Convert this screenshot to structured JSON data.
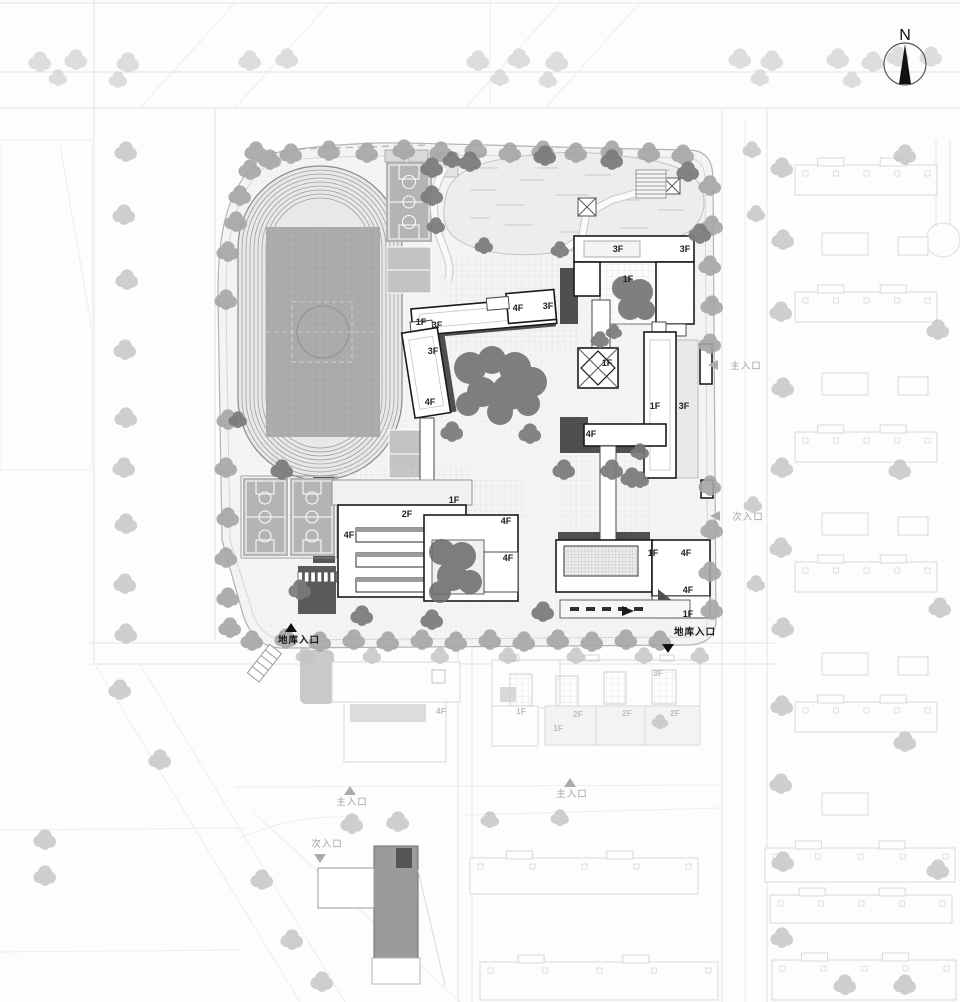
{
  "plan": {
    "north_label": "N",
    "floor_labels": [
      {
        "text": "3F",
        "x": 618,
        "y": 252,
        "tone": "dark"
      },
      {
        "text": "3F",
        "x": 685,
        "y": 252,
        "tone": "dark"
      },
      {
        "text": "1F",
        "x": 628,
        "y": 282,
        "tone": "dark"
      },
      {
        "text": "4F",
        "x": 518,
        "y": 311,
        "tone": "dark"
      },
      {
        "text": "3F",
        "x": 548,
        "y": 309,
        "tone": "dark"
      },
      {
        "text": "1F",
        "x": 421,
        "y": 325,
        "tone": "dark"
      },
      {
        "text": "3F",
        "x": 437,
        "y": 328,
        "tone": "dark"
      },
      {
        "text": "3F",
        "x": 433,
        "y": 354,
        "tone": "dark"
      },
      {
        "text": "4F",
        "x": 430,
        "y": 405,
        "tone": "dark"
      },
      {
        "text": "1F",
        "x": 607,
        "y": 366,
        "tone": "dark"
      },
      {
        "text": "1F",
        "x": 655,
        "y": 409,
        "tone": "dark"
      },
      {
        "text": "3F",
        "x": 684,
        "y": 409,
        "tone": "dark"
      },
      {
        "text": "4F",
        "x": 591,
        "y": 437,
        "tone": "dark"
      },
      {
        "text": "1F",
        "x": 454,
        "y": 503,
        "tone": "dark"
      },
      {
        "text": "2F",
        "x": 407,
        "y": 517,
        "tone": "dark"
      },
      {
        "text": "4F",
        "x": 349,
        "y": 538,
        "tone": "dark"
      },
      {
        "text": "4F",
        "x": 506,
        "y": 524,
        "tone": "dark"
      },
      {
        "text": "4F",
        "x": 508,
        "y": 561,
        "tone": "dark"
      },
      {
        "text": "1F",
        "x": 653,
        "y": 556,
        "tone": "dark"
      },
      {
        "text": "4F",
        "x": 686,
        "y": 556,
        "tone": "dark"
      },
      {
        "text": "4F",
        "x": 688,
        "y": 593,
        "tone": "dark"
      },
      {
        "text": "1F",
        "x": 688,
        "y": 617,
        "tone": "dark"
      },
      {
        "text": "3F",
        "x": 658,
        "y": 676,
        "tone": "light"
      },
      {
        "text": "4F",
        "x": 441,
        "y": 714,
        "tone": "light"
      },
      {
        "text": "1F",
        "x": 521,
        "y": 714,
        "tone": "light"
      },
      {
        "text": "2F",
        "x": 578,
        "y": 717,
        "tone": "light"
      },
      {
        "text": "2F",
        "x": 627,
        "y": 716,
        "tone": "light"
      },
      {
        "text": "2F",
        "x": 675,
        "y": 716,
        "tone": "light"
      },
      {
        "text": "1F",
        "x": 558,
        "y": 731,
        "tone": "light"
      }
    ],
    "entrance_labels": [
      {
        "text": "主入口",
        "x": 746,
        "y": 369,
        "tone": "gray",
        "arrow": {
          "dir": "left",
          "x": 714,
          "y": 365
        }
      },
      {
        "text": "次入口",
        "x": 748,
        "y": 520,
        "tone": "gray",
        "arrow": {
          "dir": "left",
          "x": 716,
          "y": 516
        }
      },
      {
        "text": "地库入口",
        "x": 299,
        "y": 643,
        "tone": "dark",
        "arrow": {
          "dir": "up",
          "x": 291,
          "y": 628
        }
      },
      {
        "text": "地库入口",
        "x": 695,
        "y": 635,
        "tone": "dark",
        "arrow": {
          "dir": "down",
          "x": 668,
          "y": 648
        }
      },
      {
        "text": "主入口",
        "x": 352,
        "y": 805,
        "tone": "gray",
        "arrow": {
          "dir": "up",
          "x": 350,
          "y": 791
        }
      },
      {
        "text": "主入口",
        "x": 572,
        "y": 797,
        "tone": "gray",
        "arrow": {
          "dir": "up",
          "x": 570,
          "y": 783
        }
      },
      {
        "text": "次入口",
        "x": 327,
        "y": 847,
        "tone": "gray",
        "arrow": {
          "dir": "down",
          "x": 320,
          "y": 858
        }
      }
    ]
  },
  "colors": {
    "building_outline": "#1a1a1a",
    "shadow": "#4f4f4f",
    "court_gray": "#b4b4b4",
    "infield_gray": "#ababab",
    "tree_dark": "#7a7a7a",
    "tree_medium": "#a6a6a6",
    "tree_light": "#d8d8d8",
    "pond": "#ededed",
    "context_line": "#d9d9d9",
    "entrance_gray": "#a2a2a2",
    "entrance_dark": "#161616"
  }
}
